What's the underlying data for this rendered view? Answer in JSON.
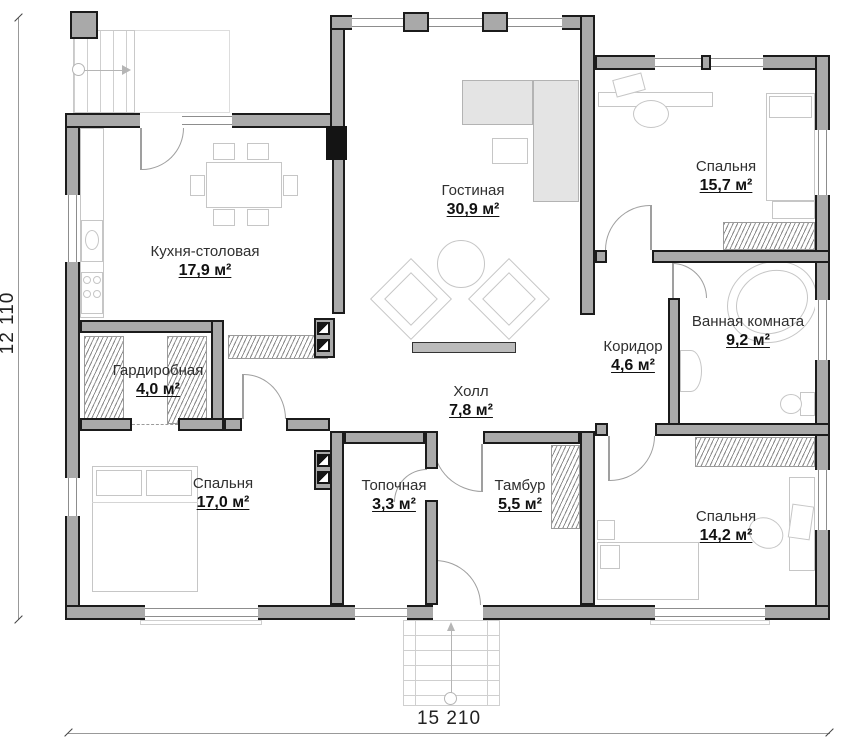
{
  "plan": {
    "type": "floor-plan",
    "language": "ru",
    "overall_width_label": "15 210",
    "overall_height_label": "12 110",
    "rooms": [
      {
        "name": "Гостиная",
        "area": "30,9 м²"
      },
      {
        "name": "Кухня-столовая",
        "area": "17,9 м²"
      },
      {
        "name": "Спальня",
        "area": "15,7 м²"
      },
      {
        "name": "Ванная комната",
        "area": "9,2 м²"
      },
      {
        "name": "Коридор",
        "area": "4,6 м²"
      },
      {
        "name": "Гардиробная",
        "area": "4,0 м²"
      },
      {
        "name": "Холл",
        "area": "7,8 м²"
      },
      {
        "name": "Спальня",
        "area": "17,0 м²"
      },
      {
        "name": "Топочная",
        "area": "3,3 м²"
      },
      {
        "name": "Тамбур",
        "area": "5,5 м²"
      },
      {
        "name": "Спальня",
        "area": "14,2 м²"
      }
    ],
    "colors": {
      "wall_fill": "#a9a9a9",
      "wall_outline": "#1b1b1b",
      "furniture_line": "#c6c6c6",
      "text": "#2f2f2f"
    }
  }
}
